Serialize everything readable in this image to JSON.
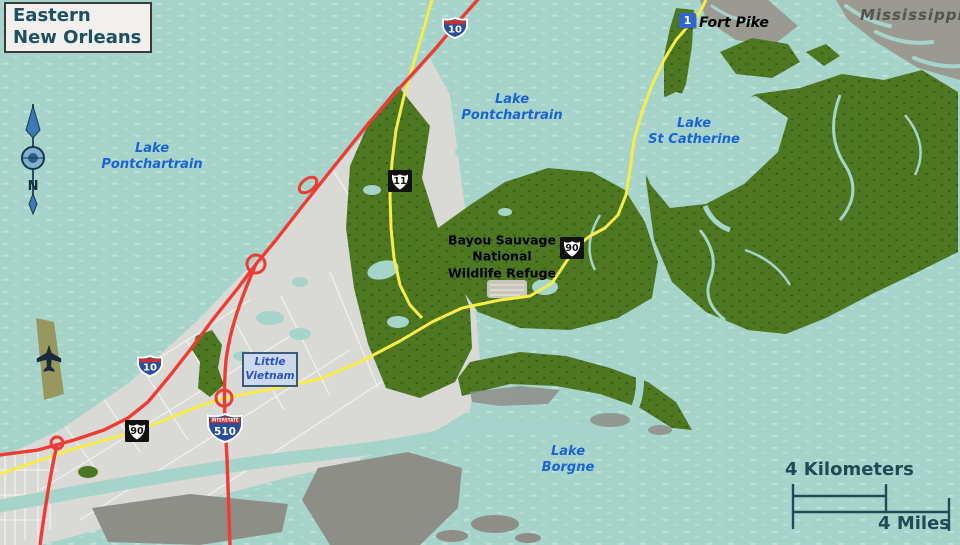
{
  "title": "Eastern\nNew Orleans",
  "compass": {
    "north": "N"
  },
  "water_labels": {
    "lake_pontchartrain_west": "Lake\nPontchartrain",
    "lake_pontchartrain_north": "Lake\nPontchartrain",
    "lake_st_catherine": "Lake\nSt Catherine",
    "lake_borgne": "Lake\nBorgne"
  },
  "land_labels": {
    "mississippi": "Mississippi",
    "refuge": "Bayou Sauvage\nNational\nWildlife Refuge",
    "little_vietnam": "Little\nVietnam"
  },
  "poi": {
    "fort_pike": {
      "marker": "1",
      "label": "Fort Pike"
    }
  },
  "shields": {
    "i10": "10",
    "i510": "510",
    "us11": "11",
    "us90": "90",
    "interstate_caption": "INTERSTATE"
  },
  "scalebar": {
    "kilometers": "4 Kilometers",
    "miles": "4 Miles"
  },
  "colors": {
    "water": "#a7d4ca",
    "water_dash": "#c2e2d9",
    "refuge_green": "#4e7722",
    "refuge_dot": "#3c5f17",
    "urban_gray": "#d9d9d5",
    "street_white": "#f4f4f0",
    "marsh_gray": "#8e8e88",
    "delta_gray": "#9a9a93",
    "interstate_red": "#ee3b34",
    "highway_yellow": "#f7ec49",
    "shield_blue": "#2b4f9e",
    "shield_red": "#c5332f",
    "lake_label_blue": "#1a63d4",
    "dark_teal": "#1d4b57",
    "marker_blue": "#3366cc",
    "title_text": "#1d5062"
  }
}
